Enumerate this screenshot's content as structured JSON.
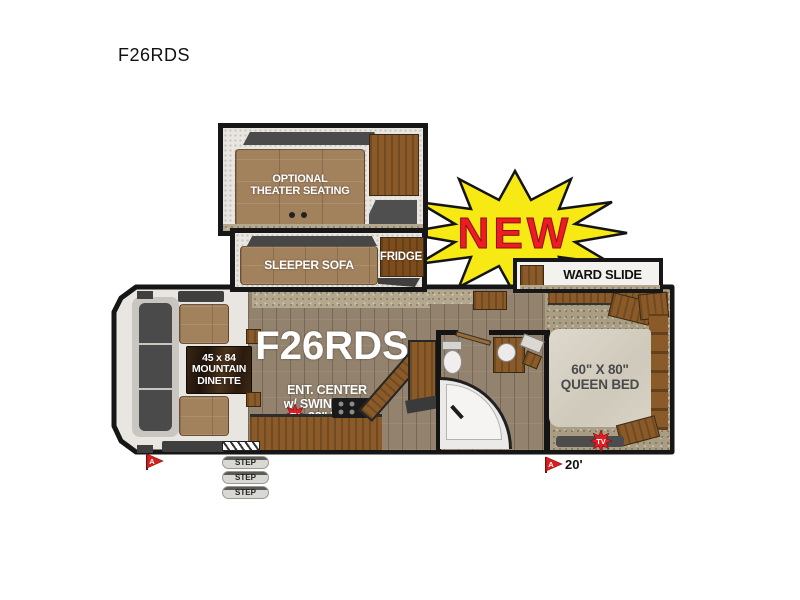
{
  "page_title": "F26RDS",
  "floorplan": {
    "model_label": "F26RDS",
    "new_badge": "NEW",
    "theater_slide_label": "OPTIONAL\nTHEATER SEATING",
    "sleeper_sofa_label": "SLEEPER SOFA",
    "fridge_label": "FRIDGE",
    "ward_slide_label": "WARD SLIDE",
    "dinette_label": "45 x 84\nMOUNTAIN\nDINETTE",
    "ent_center_label": "ENT. CENTER\nw/ SWING OUT\n32\" TV",
    "queen_bed_label": "60\" X 80\"\nQUEEN BED",
    "tv_marker": "TV",
    "flag_label": "A",
    "length_label": "20'",
    "steps": [
      "STEP",
      "STEP",
      "STEP"
    ],
    "colors": {
      "starburst_yellow": "#f6e914",
      "badge_red": "#ed1c24",
      "wood_brown": "#8a5a28",
      "upholstery_brown": "#a2815d",
      "marker_red": "#d81f1f",
      "outline_black": "#171717"
    }
  }
}
